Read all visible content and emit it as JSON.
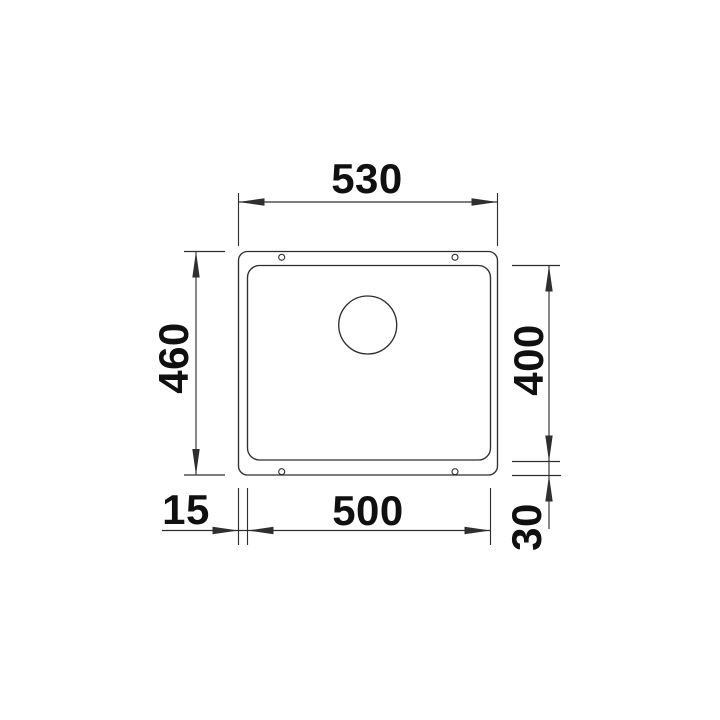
{
  "drawing": {
    "kind": "undermount-sink-installation-dimension-drawing",
    "background_color": "#ffffff",
    "line_color": "#2f2f2f",
    "text_color": "#101010",
    "dimensions": {
      "overall_width": "530",
      "overall_depth": "460",
      "bowl_depth": "400",
      "bowl_width": "500",
      "left_rim": "15",
      "rear_rim": "30"
    }
  }
}
